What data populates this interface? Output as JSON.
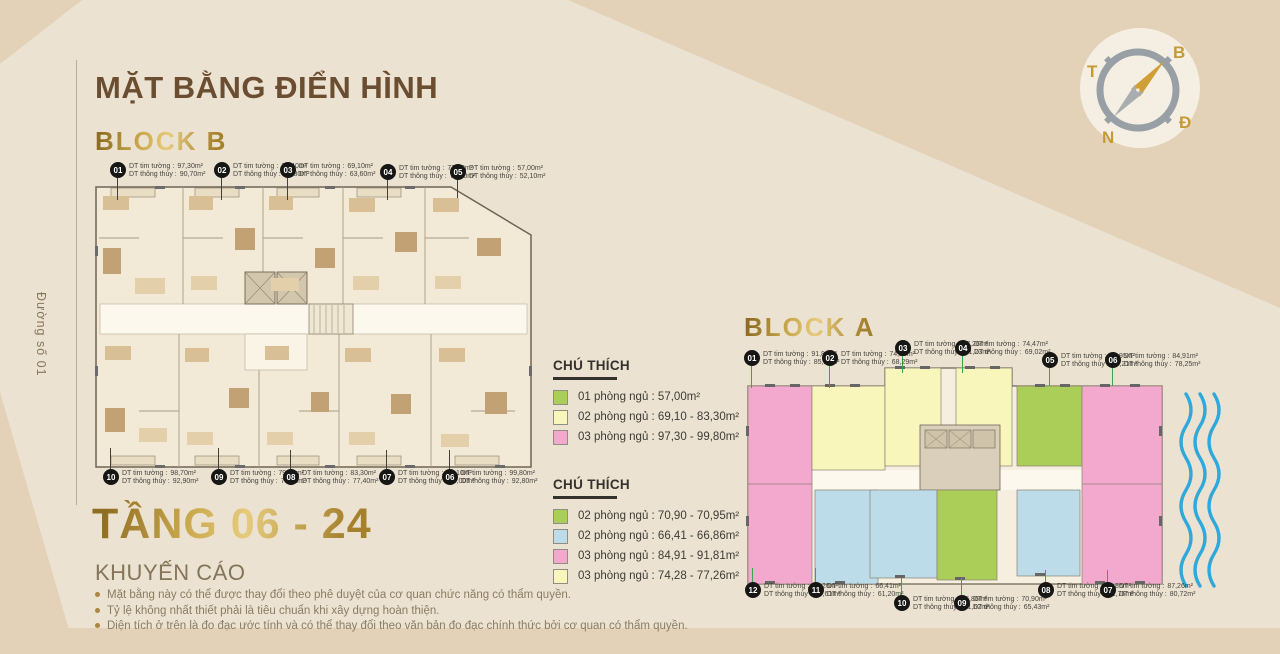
{
  "meta": {
    "title": "MẶT BẰNG ĐIỂN HÌNH",
    "floor_range": "TẦNG 06 - 24",
    "street": "Đường số 01"
  },
  "labels": {
    "tim": "DT tim tường :",
    "thuy": "DT thông thủy :"
  },
  "block_b": {
    "name": "BLOCK B",
    "units_top": [
      {
        "no": "01",
        "tim": "97,30m²",
        "thuy": "90,70m²"
      },
      {
        "no": "02",
        "tim": "71,40m²",
        "thuy": "65,80m²"
      },
      {
        "no": "03",
        "tim": "69,10m²",
        "thuy": "63,60m²"
      },
      {
        "no": "04",
        "tim": "77,10m²",
        "thuy": "71,10m²"
      },
      {
        "no": "05",
        "tim": "57,00m²",
        "thuy": "52,10m²"
      }
    ],
    "units_bottom": [
      {
        "no": "10",
        "tim": "98,70m²",
        "thuy": "92,90m²"
      },
      {
        "no": "09",
        "tim": "79,10m²",
        "thuy": "73,70m²"
      },
      {
        "no": "08",
        "tim": "83,30m²",
        "thuy": "77,40m²"
      },
      {
        "no": "07",
        "tim": "81,10m²",
        "thuy": "76,00m²"
      },
      {
        "no": "06",
        "tim": "99,80m²",
        "thuy": "92,80m²"
      }
    ]
  },
  "block_a": {
    "name": "BLOCK A",
    "units_top": [
      {
        "no": "01",
        "tim": "91,81m²",
        "thuy": "85,18m²"
      },
      {
        "no": "02",
        "tim": "74,28m²",
        "thuy": "68,29m²"
      },
      {
        "no": "03",
        "tim": "77,26m²",
        "thuy": "71,23m²"
      },
      {
        "no": "04",
        "tim": "74,47m²",
        "thuy": "69,02m²"
      },
      {
        "no": "05",
        "tim": "70,95m²",
        "thuy": "65,21m²"
      },
      {
        "no": "06",
        "tim": "84,91m²",
        "thuy": "78,25m²"
      }
    ],
    "units_bottom": [
      {
        "no": "12",
        "tim": "87,26m²",
        "thuy": "80,61m²"
      },
      {
        "no": "11",
        "tim": "66,41m²",
        "thuy": "61,20m²"
      },
      {
        "no": "10",
        "tim": "66,86m²",
        "thuy": "61,62m²"
      },
      {
        "no": "09",
        "tim": "70,90m²",
        "thuy": "65,43m²"
      },
      {
        "no": "08",
        "tim": "66,86m²",
        "thuy": "61,76m²"
      },
      {
        "no": "07",
        "tim": "87,26m²",
        "thuy": "80,72m²"
      }
    ]
  },
  "legend_b": {
    "title": "CHÚ THÍCH",
    "items": [
      {
        "color": "#aace57",
        "label": "01 phòng ngủ : 57,00m²"
      },
      {
        "color": "#f9f6bb",
        "label": "02 phòng ngủ : 69,10 - 83,30m²"
      },
      {
        "color": "#f3a9cd",
        "label": "03 phòng ngủ : 97,30 - 99,80m²"
      }
    ]
  },
  "legend_a": {
    "title": "CHÚ THÍCH",
    "items": [
      {
        "color": "#aace57",
        "label": "02 phòng ngủ : 70,90 - 70,95m²"
      },
      {
        "color": "#bcdcea",
        "label": "02 phòng ngủ : 66,41 - 66,86m²"
      },
      {
        "color": "#f3a9cd",
        "label": "03 phòng ngủ : 84,91 - 91,81m²"
      },
      {
        "color": "#f9f6bb",
        "label": "03 phòng ngủ : 74,28 - 77,26m²"
      }
    ]
  },
  "disclaimer": {
    "title": "KHUYẾN CÁO",
    "bullets": [
      "Mặt bằng này có thể được thay đổi theo phê duyệt của cơ quan chức năng có thẩm quyền.",
      "Tỷ lệ không nhất thiết phải là tiêu chuẩn khi xây dựng hoàn thiện.",
      "Diện tích ở trên là đo đạc ước tính và có thể thay đổi theo văn bản đo đạc chính thức bởi cơ quan có thẩm quyền."
    ]
  },
  "compass": {
    "north": "B",
    "east": "Đ",
    "south": "N",
    "west": "T"
  },
  "colors": {
    "background": "#ece2d1",
    "decor_band": "#e3d2b8",
    "title_brown": "#6b4e31",
    "gold": "#b8923c",
    "leader_block_a": "#3aa648",
    "water_blue": "#2fa8dc"
  }
}
